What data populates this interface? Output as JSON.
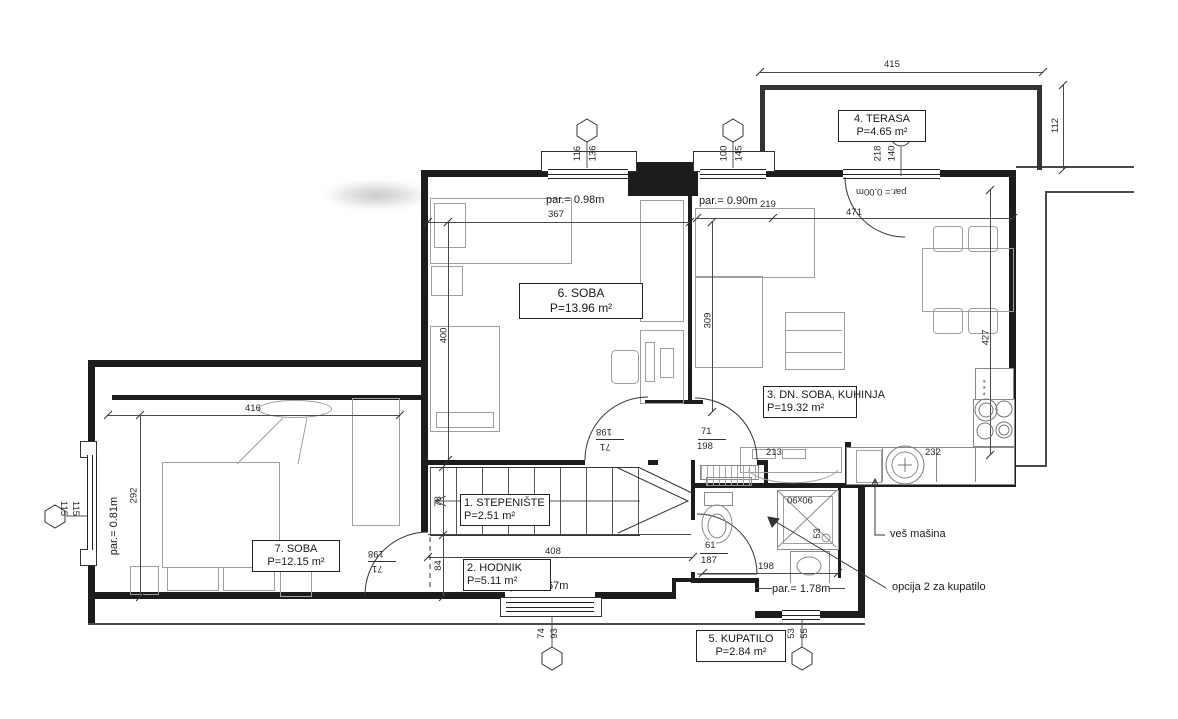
{
  "rooms": {
    "stepeniste": {
      "label": "1. STEPENIŠTE",
      "area": "P=2.51  m²"
    },
    "hodnik": {
      "label": "2. HODNIK",
      "area": "P=5.11  m²"
    },
    "dnsoba": {
      "label": "3. DN. SOBA, KUHINJA",
      "area": "P=19.32 m²"
    },
    "terasa": {
      "label": "4. TERASA",
      "area": "P=4.65  m²"
    },
    "kupatilo": {
      "label": "5. KUPATILO",
      "area": "P=2.84  m²"
    },
    "soba6": {
      "label": "6. SOBA",
      "area": "P=13.96 m²"
    },
    "soba7": {
      "label": "7. SOBA",
      "area": "P=12.15 m²"
    }
  },
  "labels": {
    "d415": "415",
    "d112": "112",
    "d116": "116",
    "d136": "136",
    "d100": "100",
    "d145": "145",
    "d140": "140",
    "d218": "218",
    "d367": "367",
    "d219": "219",
    "d471": "471",
    "d400": "400",
    "d309": "309",
    "d427": "427",
    "d416": "416",
    "d292": "292",
    "d78": "78",
    "d84": "84",
    "d408": "408",
    "d198": "198",
    "d71": "71",
    "d61": "61",
    "d187": "187",
    "d213": "213",
    "d232": "232",
    "d53": "53",
    "d55": "55",
    "d74": "74",
    "d93": "93",
    "d115": "115",
    "par000": "par.= 0.00m",
    "par098": "par.= 0.98m",
    "par090": "par.= 0.90m",
    "par081": "par.= 0.81m",
    "par167": "par.= 1.67m",
    "par178": "par.= 1.78m",
    "shower": "90x90",
    "stars": "* * *"
  },
  "annotations": {
    "washer": "veš mašina",
    "option": "opcija 2 za kupatilo"
  }
}
